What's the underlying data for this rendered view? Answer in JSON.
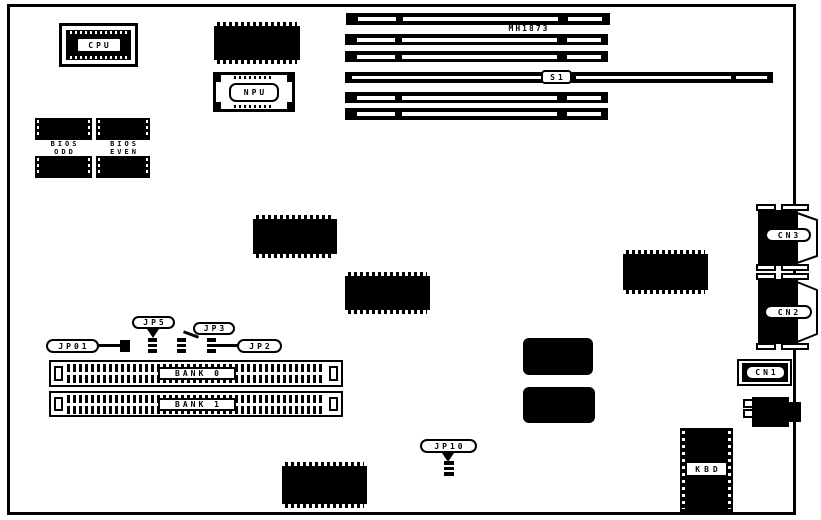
{
  "diagram": {
    "model_label": "MH1873",
    "components": {
      "cpu": "CPU",
      "npu": "NPU",
      "bios_odd": {
        "line1": "BIOS",
        "line2": "ODD"
      },
      "bios_even": {
        "line1": "BIOS",
        "line2": "EVEN"
      },
      "kbd": "KBD"
    },
    "slots": {
      "s1": "S1"
    },
    "jumpers": {
      "jp01": "JP01",
      "jp5": "JP5",
      "jp3": "JP3",
      "jp2": "JP2",
      "jp10": "JP10"
    },
    "memory_banks": {
      "bank0": "BANK 0",
      "bank1": "BANK 1"
    },
    "connectors": {
      "cn1": "CN1",
      "cn2": "CN2",
      "cn3": "CN3"
    },
    "colors": {
      "ink": "#000000",
      "paper": "#ffffff"
    }
  }
}
